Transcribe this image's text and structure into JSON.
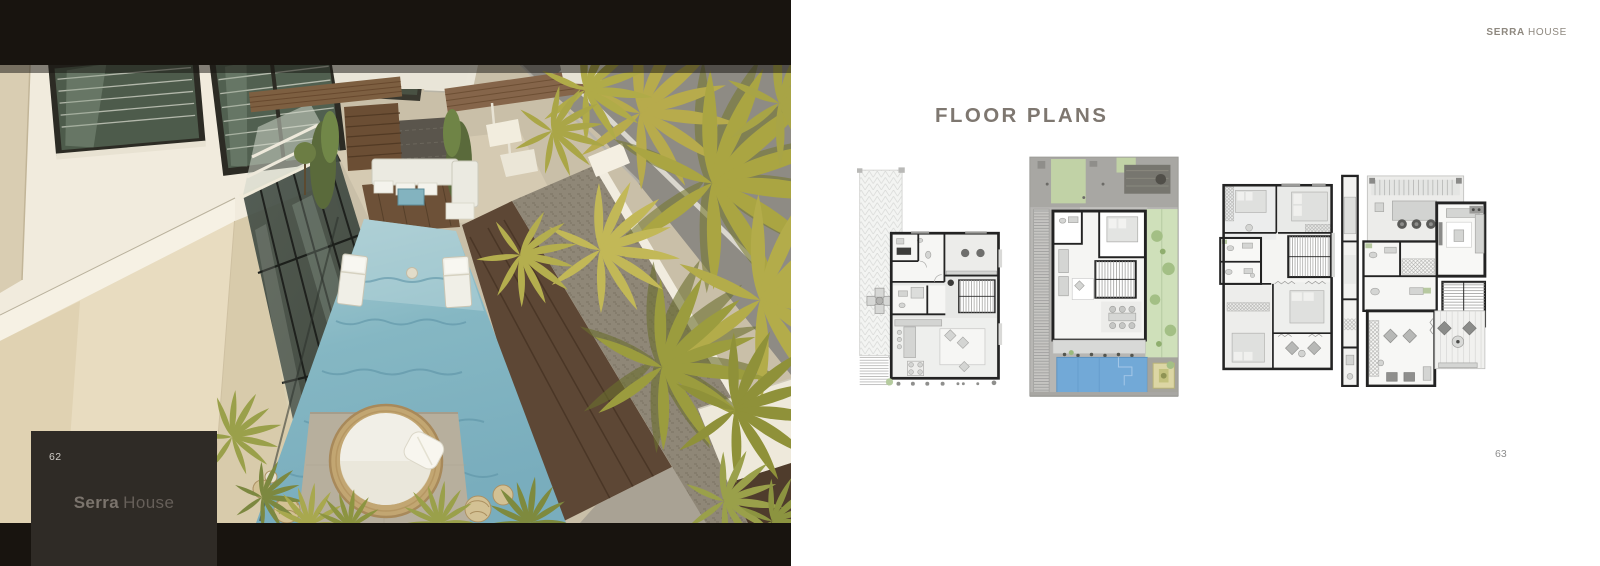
{
  "left_page": {
    "page_number": "62",
    "title_primary": "Serra",
    "title_secondary": "House"
  },
  "right_page": {
    "brand_primary": "SERRA",
    "brand_secondary": "HOUSE",
    "heading": "FLOOR PLANS",
    "page_number": "63",
    "plans": [
      {
        "name": "ground-floor-plan"
      },
      {
        "name": "site-and-pool-level-plan"
      },
      {
        "name": "bedroom-level-plan"
      },
      {
        "name": "top-level-plan"
      }
    ]
  },
  "photo": {
    "subject": "aerial-render-pool-courtyard"
  },
  "colors": {
    "frame_black": "#18140f",
    "overlay_box": "#2f2b26",
    "heading_text": "#7e7770",
    "brand_text": "#8e887f",
    "photo_pool": "#85b7c3",
    "plan_pool": "#72a9d7",
    "plan_garden": "#cfe0ba"
  }
}
